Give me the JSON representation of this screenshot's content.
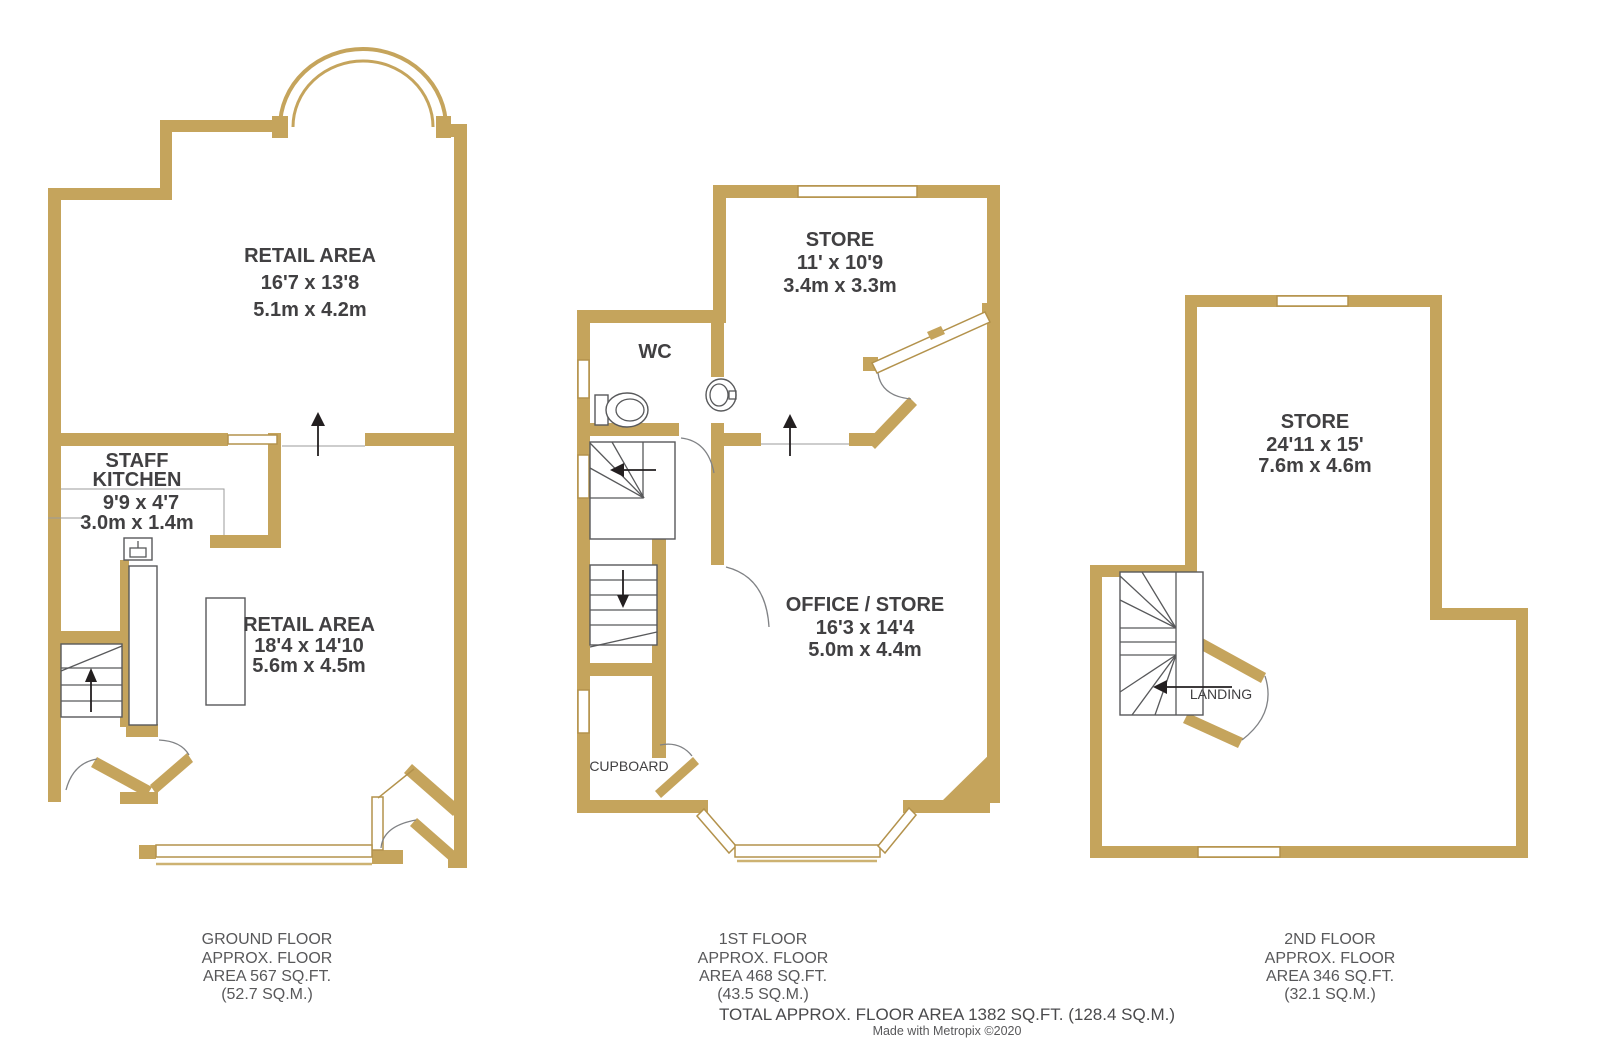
{
  "colors": {
    "wall": "#c5a45c",
    "window_outline": "#b3924c",
    "fixture_line": "#58595b",
    "room_text": "#414042",
    "footer_text": "#58585a",
    "arrow": "#231f20",
    "background": "#ffffff"
  },
  "plans": {
    "ground": {
      "rooms": [
        {
          "id": "retail-area-front",
          "lines": [
            "RETAIL AREA",
            "16'7 x 13'8",
            "5.1m x 4.2m"
          ]
        },
        {
          "id": "staff-kitchen",
          "lines": [
            "STAFF",
            "KITCHEN",
            "9'9 x 4'7",
            "3.0m x 1.4m"
          ]
        },
        {
          "id": "retail-area-rear",
          "lines": [
            "RETAIL AREA",
            "18'4 x 14'10",
            "5.6m x 4.5m"
          ]
        }
      ],
      "footer": [
        "GROUND FLOOR",
        "APPROX. FLOOR",
        "AREA 567 SQ.FT.",
        "(52.7 SQ.M.)"
      ]
    },
    "first": {
      "rooms": [
        {
          "id": "store",
          "lines": [
            "STORE",
            "11' x 10'9",
            "3.4m x 3.3m"
          ]
        },
        {
          "id": "wc",
          "lines": [
            "WC"
          ]
        },
        {
          "id": "office-store",
          "lines": [
            "OFFICE / STORE",
            "16'3 x 14'4",
            "5.0m x 4.4m"
          ]
        },
        {
          "id": "cupboard",
          "lines": [
            "CUPBOARD"
          ]
        }
      ],
      "footer": [
        "1ST FLOOR",
        "APPROX. FLOOR",
        "AREA 468 SQ.FT.",
        "(43.5 SQ.M.)"
      ]
    },
    "second": {
      "rooms": [
        {
          "id": "store",
          "lines": [
            "STORE",
            "24'11 x 15'",
            "7.6m x 4.6m"
          ]
        },
        {
          "id": "landing",
          "lines": [
            "LANDING"
          ]
        }
      ],
      "footer": [
        "2ND FLOOR",
        "APPROX. FLOOR",
        "AREA 346 SQ.FT.",
        "(32.1 SQ.M.)"
      ]
    }
  },
  "summary": {
    "total": "TOTAL APPROX. FLOOR AREA 1382 SQ.FT. (128.4 SQ.M.)",
    "credit": "Made with Metropix ©2020"
  }
}
